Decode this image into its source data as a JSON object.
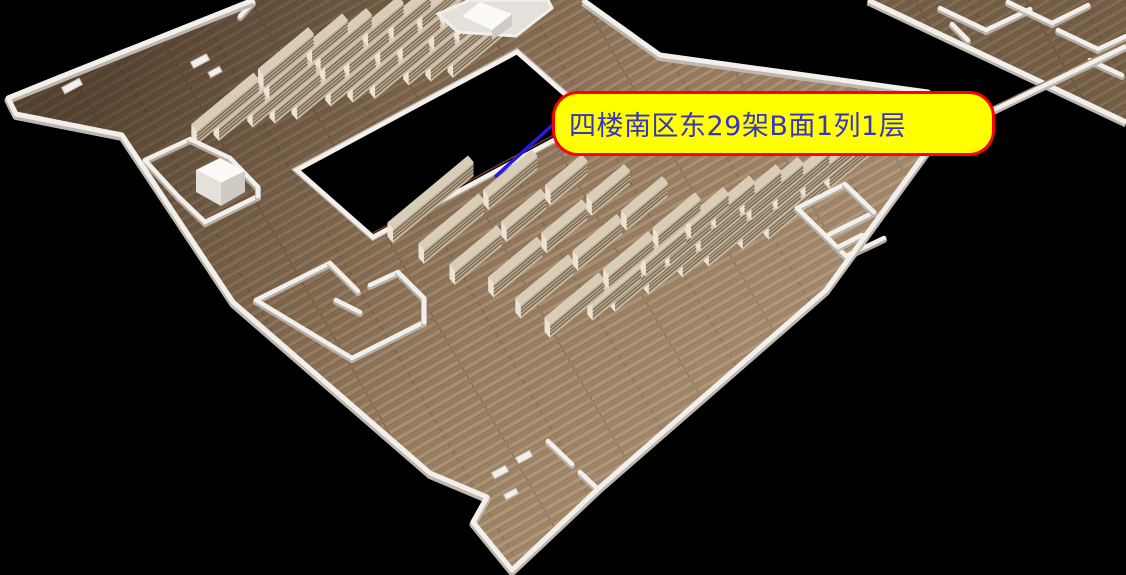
{
  "tooltip": {
    "text": "四楼南区东29架B面1列1层",
    "bg_color": "#ffff00",
    "border_color": "#ff0000",
    "text_color": "#3733c4",
    "x": 552,
    "y": 91,
    "w": 443,
    "h": 65,
    "pointer_color": "#2519e3",
    "pointer_line": [
      [
        567,
        112
      ],
      [
        496,
        176
      ]
    ]
  },
  "colors": {
    "background": "#000000",
    "wall": "#f3f0ec",
    "wall_shadow": "#bdb7b0",
    "wall_light": "#fbfaf8",
    "block_top": "#fbfaf8",
    "block_front": "#e4e0da",
    "block_side": "#cfcac3",
    "floor_base": "#a08569",
    "plank_a": "#a78c6e",
    "plank_b": "#957a5e",
    "plank_seam": "#7c6650",
    "shade_dark": "rgba(30,18,8,0.55)",
    "shade_light": "rgba(255,230,200,0.16)",
    "hole_fill": "#000000",
    "hole_trim": "#8b4a3a",
    "shelf_top": "#d9cdb8",
    "shelf_front": "#c6b79e",
    "shelf_stripe": "#7e6e59",
    "shelf_end": "#ebe3d4"
  },
  "floor": {
    "outline": [
      [
        253,
        0
      ],
      [
        583,
        0
      ],
      [
        660,
        55
      ],
      [
        928,
        92
      ],
      [
        935,
        140
      ],
      [
        826,
        290
      ],
      [
        600,
        487
      ],
      [
        512,
        570
      ],
      [
        473,
        522
      ],
      [
        487,
        497
      ],
      [
        430,
        473
      ],
      [
        233,
        302
      ],
      [
        122,
        135
      ],
      [
        16,
        114
      ],
      [
        8,
        98
      ],
      [
        60,
        77
      ]
    ],
    "wall_path": [
      [
        583,
        0
      ],
      [
        660,
        55
      ],
      [
        928,
        92
      ],
      [
        935,
        140
      ],
      [
        826,
        290
      ],
      [
        600,
        487
      ],
      [
        512,
        570
      ],
      [
        473,
        522
      ],
      [
        487,
        497
      ],
      [
        430,
        473
      ],
      [
        233,
        302
      ],
      [
        122,
        135
      ],
      [
        16,
        114
      ],
      [
        8,
        98
      ],
      [
        60,
        77
      ],
      [
        253,
        0
      ]
    ]
  },
  "atrium": {
    "pts": [
      [
        297,
        170
      ],
      [
        517,
        52
      ],
      [
        593,
        119
      ],
      [
        373,
        237
      ]
    ],
    "trim_edge": [
      [
        373,
        233
      ],
      [
        589,
        116
      ]
    ]
  },
  "east_wing": {
    "outline": [
      [
        868,
        0
      ],
      [
        1126,
        0
      ],
      [
        1126,
        122
      ]
    ],
    "edge_wall": [
      [
        868,
        0
      ],
      [
        1126,
        122
      ]
    ],
    "inner_walls": [
      [
        [
          940,
          8
        ],
        [
          986,
          30
        ]
      ],
      [
        [
          986,
          30
        ],
        [
          1030,
          9
        ]
      ],
      [
        [
          1008,
          2
        ],
        [
          1052,
          23
        ]
      ],
      [
        [
          1052,
          23
        ],
        [
          1088,
          5
        ]
      ],
      [
        [
          1058,
          30
        ],
        [
          1098,
          49
        ]
      ],
      [
        [
          1098,
          49
        ],
        [
          1126,
          36
        ]
      ],
      [
        [
          1090,
          60
        ],
        [
          1122,
          75
        ]
      ],
      [
        [
          952,
          24
        ],
        [
          968,
          40
        ]
      ]
    ],
    "bridge_strip": [
      [
        985,
        110
      ],
      [
        1126,
        42
      ],
      [
        1126,
        50
      ],
      [
        988,
        117
      ]
    ],
    "bridge_wall": [
      [
        985,
        114
      ],
      [
        1126,
        46
      ]
    ]
  },
  "structures": {
    "elevator_walls": [
      [
        [
          145,
          160
        ],
        [
          190,
          139
        ]
      ],
      [
        [
          145,
          160
        ],
        [
          178,
          196
        ]
      ],
      [
        [
          190,
          139
        ],
        [
          230,
          158
        ]
      ],
      [
        [
          230,
          158
        ],
        [
          258,
          187
        ]
      ],
      [
        [
          178,
          196
        ],
        [
          205,
          222
        ]
      ],
      [
        [
          205,
          222
        ],
        [
          258,
          196
        ]
      ],
      [
        [
          258,
          187
        ],
        [
          258,
          196
        ]
      ]
    ],
    "elevator_cube": {
      "top": [
        [
          196,
          170
        ],
        [
          220,
          158
        ],
        [
          245,
          171
        ],
        [
          221,
          183
        ]
      ],
      "front": [
        [
          196,
          170
        ],
        [
          221,
          183
        ],
        [
          221,
          206
        ],
        [
          196,
          192
        ]
      ],
      "side": [
        [
          221,
          183
        ],
        [
          245,
          171
        ],
        [
          245,
          192
        ],
        [
          221,
          206
        ]
      ]
    },
    "southwest_room_walls": [
      [
        [
          256,
          300
        ],
        [
          330,
          263
        ]
      ],
      [
        [
          256,
          300
        ],
        [
          352,
          358
        ]
      ],
      [
        [
          352,
          358
        ],
        [
          424,
          322
        ]
      ],
      [
        [
          330,
          263
        ],
        [
          358,
          291
        ]
      ],
      [
        [
          370,
          285
        ],
        [
          398,
          272
        ]
      ],
      [
        [
          398,
          272
        ],
        [
          424,
          298
        ]
      ],
      [
        [
          424,
          298
        ],
        [
          424,
          322
        ]
      ],
      [
        [
          336,
          300
        ],
        [
          360,
          312
        ]
      ]
    ],
    "east_room_walls": [
      [
        [
          797,
          208
        ],
        [
          845,
          184
        ]
      ],
      [
        [
          797,
          208
        ],
        [
          826,
          236
        ]
      ],
      [
        [
          826,
          236
        ],
        [
          874,
          212
        ]
      ],
      [
        [
          845,
          184
        ],
        [
          874,
          212
        ]
      ],
      [
        [
          826,
          236
        ],
        [
          846,
          256
        ]
      ],
      [
        [
          846,
          256
        ],
        [
          884,
          238
        ]
      ],
      [
        [
          838,
          247
        ],
        [
          862,
          235
        ]
      ]
    ],
    "bay_walls": [
      [
        [
          548,
          441
        ],
        [
          572,
          464
        ]
      ],
      [
        [
          580,
          472
        ],
        [
          598,
          489
        ]
      ]
    ],
    "nw_wall_stub": [
      [
        253,
        2
      ],
      [
        240,
        16
      ]
    ],
    "stair_block": {
      "base": [
        [
          438,
          14
        ],
        [
          470,
          0
        ],
        [
          548,
          0
        ],
        [
          552,
          8
        ],
        [
          516,
          36
        ],
        [
          458,
          32
        ]
      ],
      "cube_top": [
        [
          480,
          2
        ],
        [
          462,
          16
        ],
        [
          492,
          30
        ],
        [
          512,
          14
        ]
      ],
      "cube_front": [
        [
          492,
          30
        ],
        [
          512,
          14
        ],
        [
          512,
          26
        ],
        [
          492,
          40
        ]
      ]
    },
    "door_frames": [
      {
        "x": 500,
        "y": 472,
        "w": 16,
        "h": 7
      },
      {
        "x": 524,
        "y": 457,
        "w": 16,
        "h": 7
      },
      {
        "x": 511,
        "y": 494,
        "w": 14,
        "h": 6
      },
      {
        "x": 72,
        "y": 86,
        "w": 20,
        "h": 7
      },
      {
        "x": 200,
        "y": 61,
        "w": 18,
        "h": 7
      },
      {
        "x": 215,
        "y": 72,
        "w": 13,
        "h": 6
      }
    ]
  },
  "shelves": {
    "dir": [
      0.77,
      -0.64
    ],
    "dep": [
      -5.5,
      -6.3
    ],
    "height": 14,
    "north_rows": [
      [
        193,
        148,
        160
      ],
      [
        219,
        141,
        165
      ],
      [
        245,
        134,
        168
      ],
      [
        271,
        127,
        170
      ],
      [
        297,
        120,
        172
      ],
      [
        323,
        113,
        172
      ],
      [
        349,
        106,
        168
      ],
      [
        375,
        99,
        136
      ],
      [
        401,
        92,
        125
      ],
      [
        427,
        85,
        90
      ],
      [
        453,
        78,
        70
      ]
    ],
    "south_rows": [
      [
        393,
        243,
        110
      ],
      [
        424,
        264,
        150
      ],
      [
        455,
        285,
        170
      ],
      [
        486,
        304,
        185
      ],
      [
        517,
        322,
        195
      ],
      [
        550,
        338,
        195
      ],
      [
        585,
        327,
        185
      ],
      [
        615,
        312,
        180
      ],
      [
        645,
        298,
        175
      ],
      [
        675,
        284,
        170
      ],
      [
        705,
        270,
        165
      ],
      [
        735,
        256,
        155
      ],
      [
        765,
        243,
        145
      ]
    ]
  }
}
